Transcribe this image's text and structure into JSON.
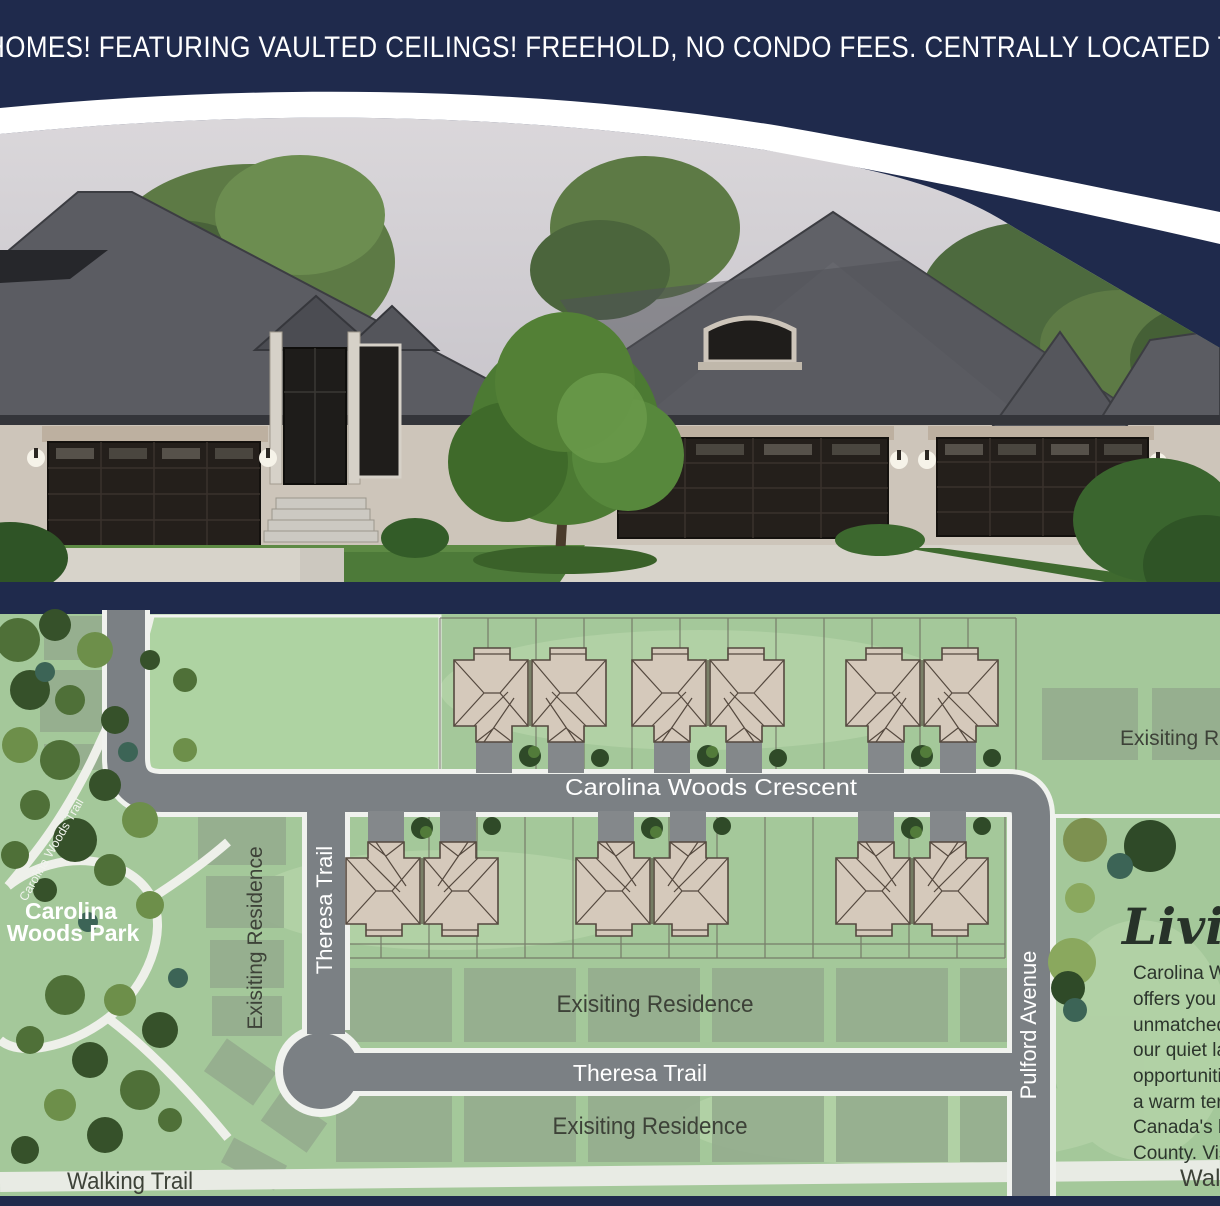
{
  "banner": {
    "headline": "HOMES! FEATURING VAULTED CEILINGS! FREEHOLD, NO CONDO FEES. CENTRALLY LOCATED T",
    "background": "#1f2a4c",
    "text_color": "#ffffff"
  },
  "photo": {
    "subject_icon": "townhome-rendering"
  },
  "map": {
    "roads": {
      "crescent": "Carolina Woods Crescent",
      "theresa_vertical": "Theresa Trail",
      "theresa_horizontal": "Theresa Trail",
      "pulford": "Pulford Avenue"
    },
    "trails": {
      "walking_left": "Walking Trail",
      "walking_right": "Walk",
      "park_trail": "Carolina Woods Trail"
    },
    "park": {
      "line1": "Carolina",
      "line2": "Woods Park"
    },
    "areas": {
      "existing_vertical": "Exisiting Residence",
      "existing_row1": "Exisiting Residence",
      "existing_row2": "Exisiting Residence",
      "existing_topright": "Exisiting R"
    }
  },
  "info_panel": {
    "heading": "Living",
    "lines": [
      "Carolina W",
      "offers you",
      "unmatched",
      "our quiet la",
      "opportuniti",
      "a warm ter",
      "Canada's b",
      "County. Vis"
    ]
  },
  "colors": {
    "navy": "#1f2a4c",
    "swoosh_white": "#ffffff",
    "map_green": "#a4c89a",
    "field_green": "#aed3a2",
    "existing_lot": "#95ad8e",
    "road_gray": "#7b8084",
    "road_edge": "#f0f2ee",
    "footprint_tan": "#d5c9bb",
    "footprint_outline": "#55493f",
    "roof_gray": "#5b5c62",
    "wall_beige": "#cdc5ba",
    "garage_brown": "#241f1b",
    "lawn_green": "#4d7a39",
    "driveway": "#d7d3ca",
    "label_dark": "#3d4238"
  }
}
